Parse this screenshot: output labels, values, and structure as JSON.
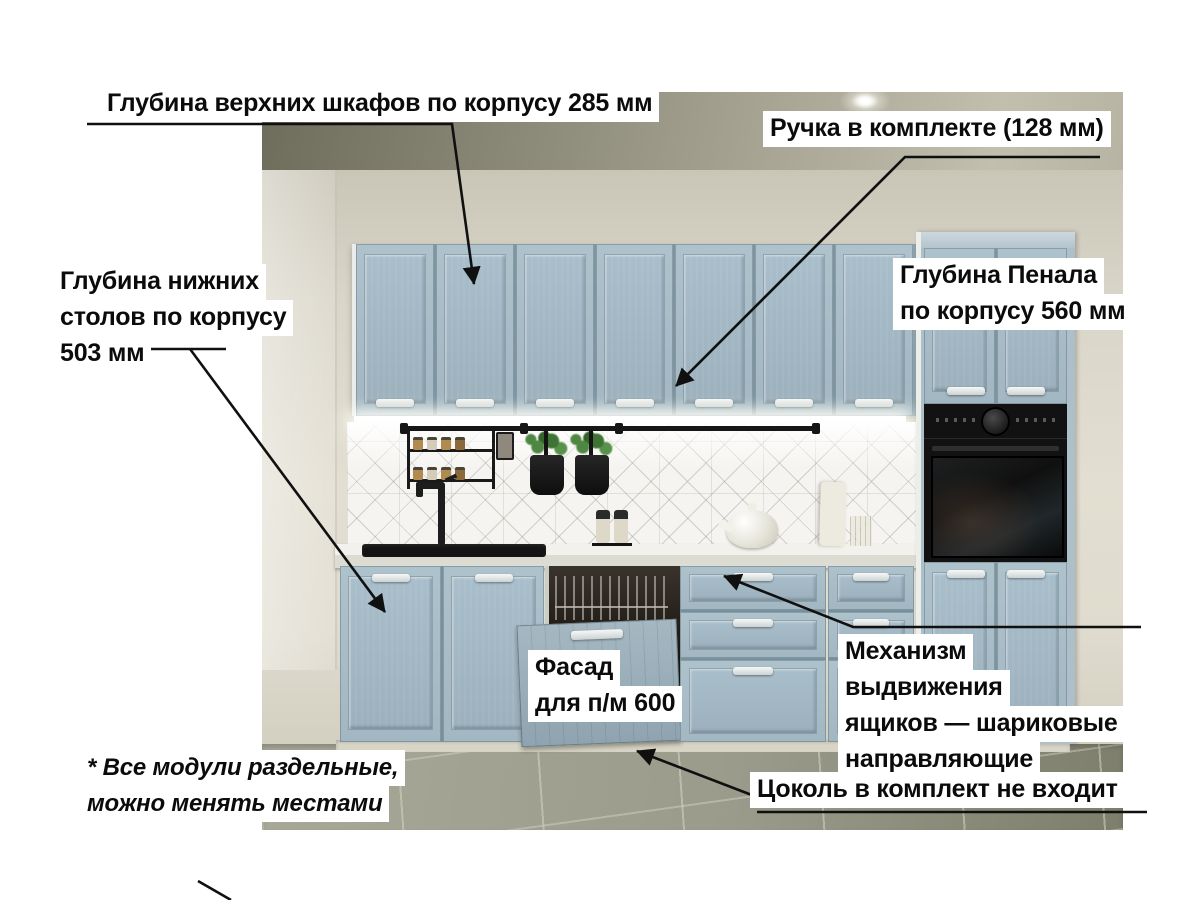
{
  "annotations": {
    "upper_depth": {
      "text": "Глубина верхних шкафов по корпусу 285 мм"
    },
    "handle_included": {
      "text": "Ручка в комплекте (128 мм)"
    },
    "lower_depth": {
      "lines": [
        "Глубина нижних",
        "столов по корпусу",
        "503 мм"
      ]
    },
    "penal_depth": {
      "lines": [
        "Глубина Пенала",
        "по корпусу 560 мм"
      ]
    },
    "dishwasher_facade": {
      "lines": [
        "Фасад",
        "для п/м 600"
      ]
    },
    "drawer_mechanism": {
      "lines": [
        "Механизм",
        "выдвижения",
        "ящиков — шариковые",
        "направляющие"
      ]
    },
    "plinth_note": {
      "text": "Цоколь в комплект не входит"
    },
    "modules_note": {
      "lines": [
        "* Все модули раздельные,",
        "можно менять местами"
      ]
    }
  },
  "kitchen": {
    "upper_door_count": 7,
    "base_door_count": 2,
    "penal_upper_door_count": 2,
    "penal_lower_door_count": 2,
    "drawer_rows": 3,
    "shelf_jar_count": 4
  },
  "colors": {
    "cabinet_front": "#a7bcc7",
    "cabinet_seam": "#7f949f",
    "handle": "#f6f8f7",
    "wall": "#dcd8cb",
    "ceiling": "#8f8d7c",
    "floor": "#9b9b8c",
    "countertop": "#f2f1eb",
    "backsplash": "#f5f4f0",
    "appliance_black": "#121212",
    "label_background": "#ffffff",
    "label_text": "#0b0b0b",
    "arrow": "#101010"
  }
}
